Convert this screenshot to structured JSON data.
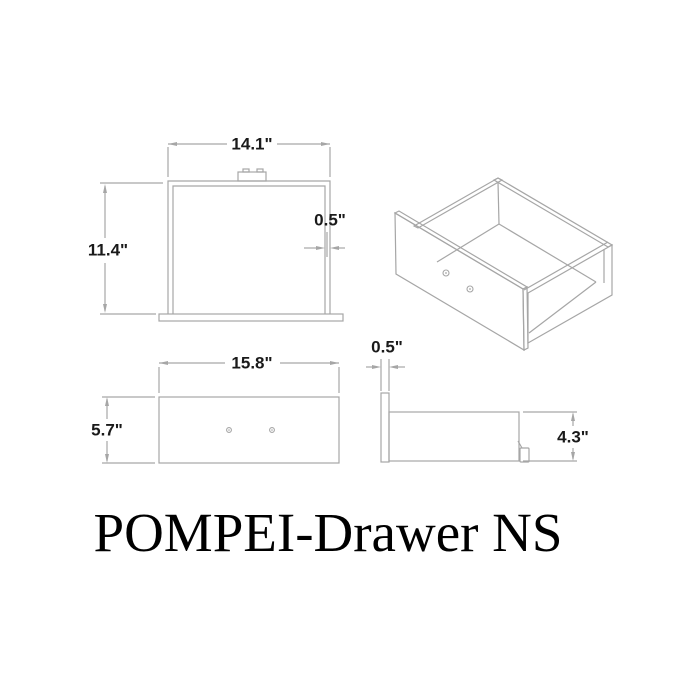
{
  "title": "POMPEI-Drawer NS",
  "dimensions": {
    "top_view": {
      "width": "14.1\"",
      "depth": "11.4\"",
      "wall_thickness": "0.5\""
    },
    "front_view": {
      "width": "15.8\"",
      "height": "5.7\""
    },
    "side_view": {
      "front_panel_thickness": "0.5\"",
      "side_height": "4.3\""
    }
  },
  "colors": {
    "line": "#a6a6a6",
    "dim_text": "#1a1a1a",
    "title": "#000000",
    "background": "#ffffff"
  }
}
